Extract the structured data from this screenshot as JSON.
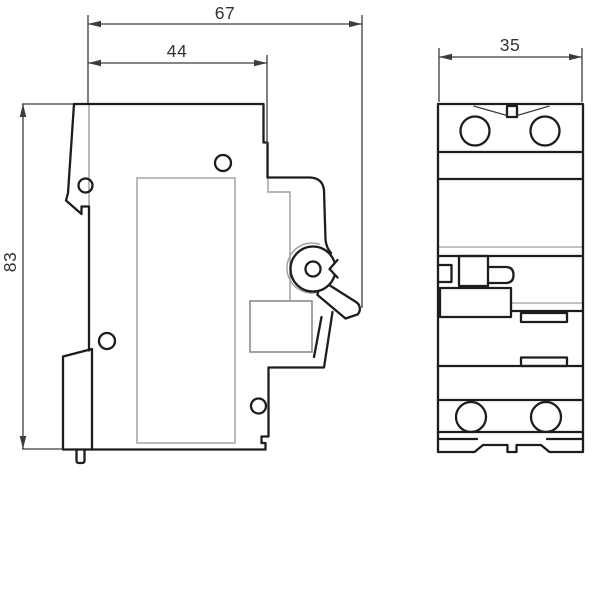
{
  "drawing": {
    "type": "technical-dimension-drawing",
    "subject": "modular circuit breaker - side view and front view",
    "dimensions": {
      "overall_depth": "67",
      "body_depth": "44",
      "height": "83",
      "width": "35"
    },
    "colors": {
      "outline": "#1d1d1d",
      "detail": "#9d9d9d",
      "panel": "#8a8a8a",
      "dimension": "#3c3c3c",
      "label_text": "#333333",
      "fill": "#ffffff"
    }
  }
}
